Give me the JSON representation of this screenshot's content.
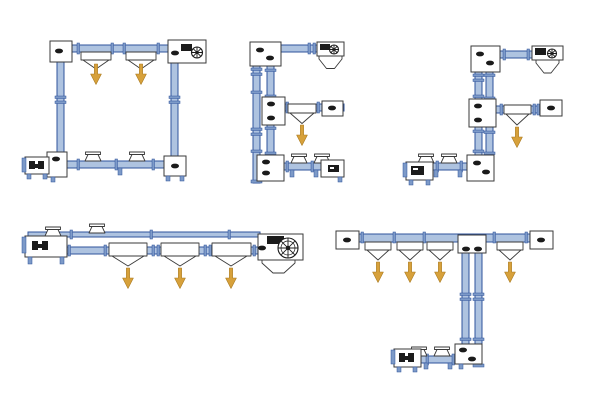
{
  "canvas": {
    "width": 600,
    "height": 400,
    "background": "#ffffff"
  },
  "colors": {
    "tube_fill": "#aec3e0",
    "tube_stroke": "#2f539b",
    "flange_fill": "#7d9ac8",
    "unit_fill": "#ffffff",
    "unit_stroke": "#3a3a3a",
    "component_dark": "#1b1b1b",
    "arrow_fill": "#d7a13b",
    "arrow_stroke": "#a9791f"
  },
  "diagram": {
    "kind": "tubular-conveyor-layout-options",
    "configurations": [
      {
        "id": "closed-loop",
        "shape": "closed rectangular loop",
        "discharge_arrows": 2,
        "inlet_hoppers": 2,
        "drive_unit": true
      },
      {
        "id": "e-shape",
        "shape": "E-shaped circuit, three right arms",
        "discharge_arrows": 1,
        "inlet_hoppers": 2,
        "drive_unit": true
      },
      {
        "id": "f-shape",
        "shape": "F-shaped circuit, two right arms and left foot",
        "discharge_arrows": 1,
        "inlet_hoppers": 2,
        "drive_unit": true
      },
      {
        "id": "in-line",
        "shape": "straight in-line run",
        "discharge_arrows": 3,
        "inlet_hoppers": 2,
        "drive_unit": true
      },
      {
        "id": "t-shape",
        "shape": "T-shaped top run with vertical drop to left foot",
        "discharge_arrows": 4,
        "inlet_hoppers": 2,
        "drive_unit": false
      }
    ]
  }
}
